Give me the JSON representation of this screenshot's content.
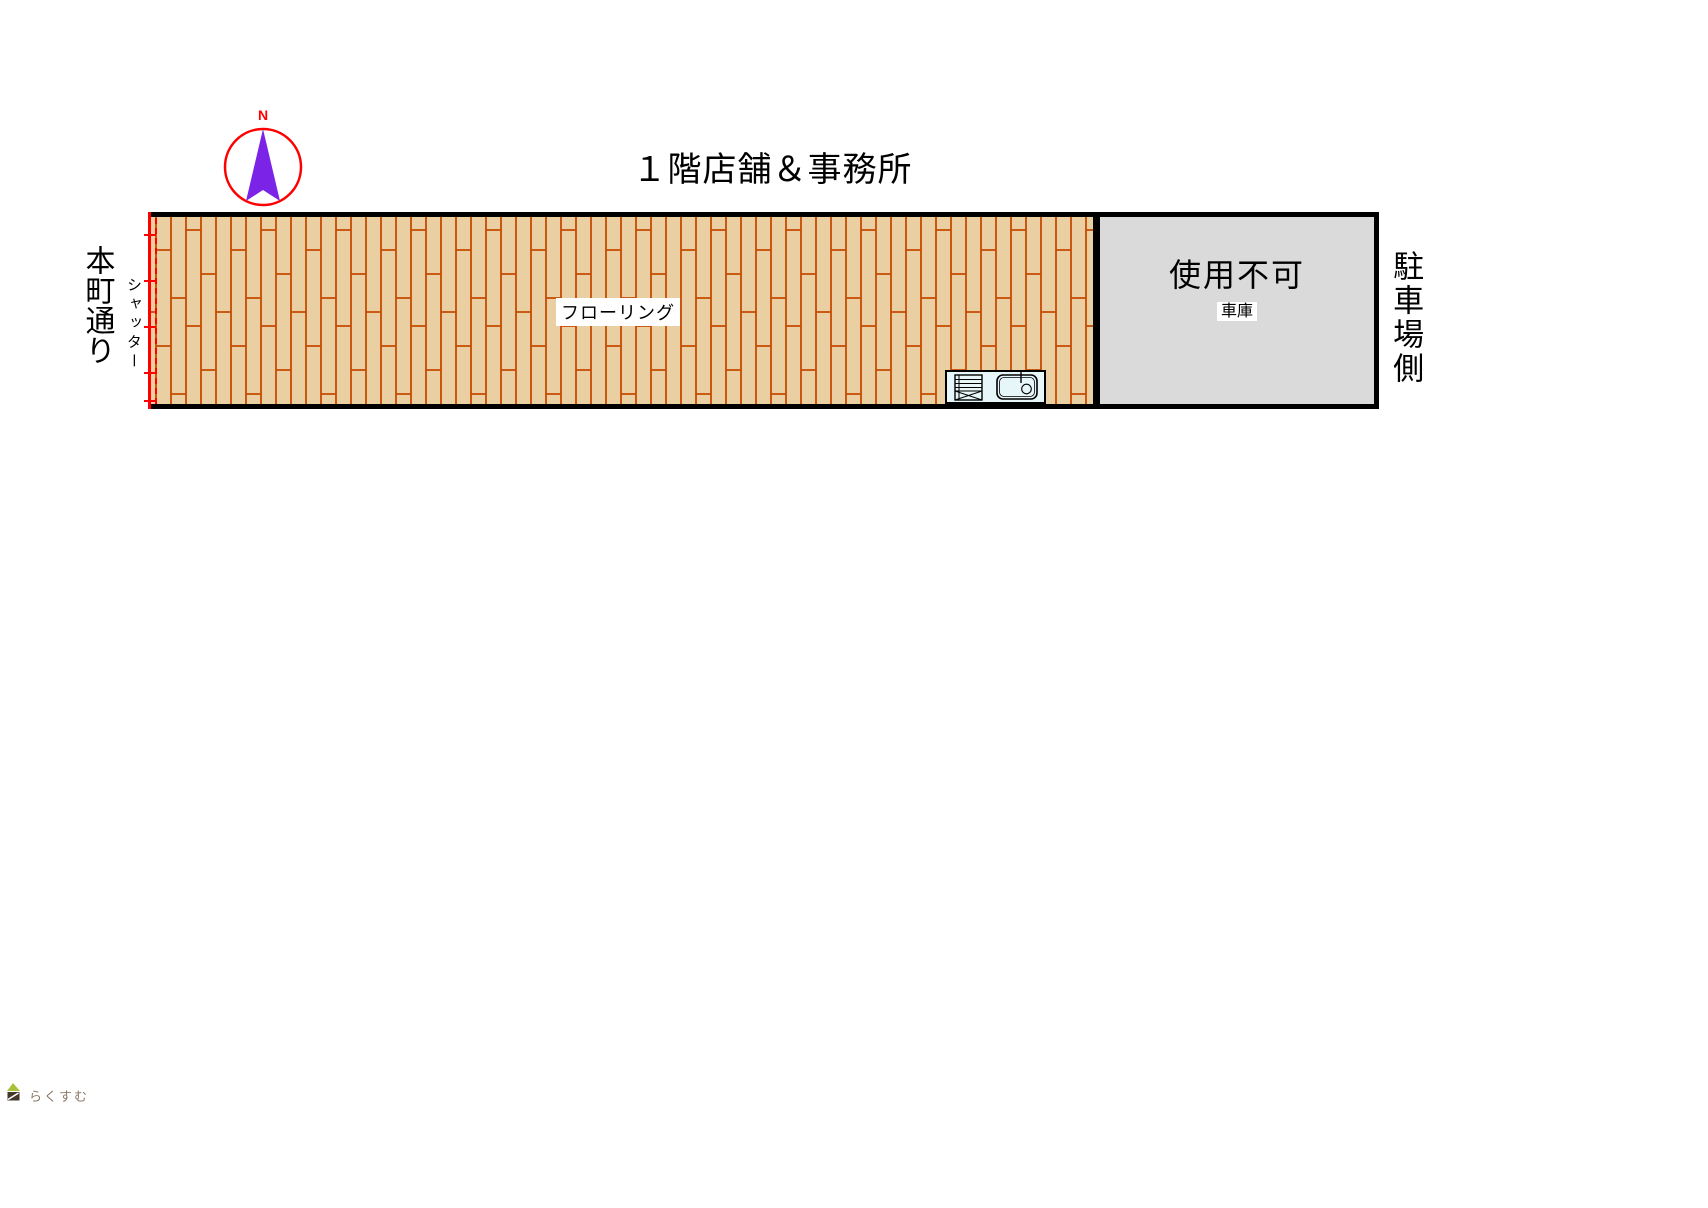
{
  "page": {
    "background": "#ffffff"
  },
  "title": "１階店舗＆事務所",
  "compass": {
    "north_label": "N",
    "circle_color": "#ff0000",
    "needle_color": "#7b24e8",
    "label_color": "#ff0000"
  },
  "left_side": {
    "street_label": "本町通り",
    "shutter_label": "シャッター",
    "shutter_color": "#ff0000"
  },
  "flooring": {
    "label": "フローリング",
    "floor_color": "#e9cfa1",
    "line_color": "#c64a00"
  },
  "garage": {
    "status": "使用不可",
    "name": "車庫",
    "fill_color": "#dadada",
    "wall_color": "#000000"
  },
  "right_side": {
    "parking_label": "駐車場側"
  },
  "kitchen": {
    "fill_color": "#e7f6f9"
  },
  "watermark": {
    "text": "らくすむ",
    "text_color": "#8a7a68",
    "leaf_color": "#a9c23a",
    "pot_color": "#43372a"
  }
}
